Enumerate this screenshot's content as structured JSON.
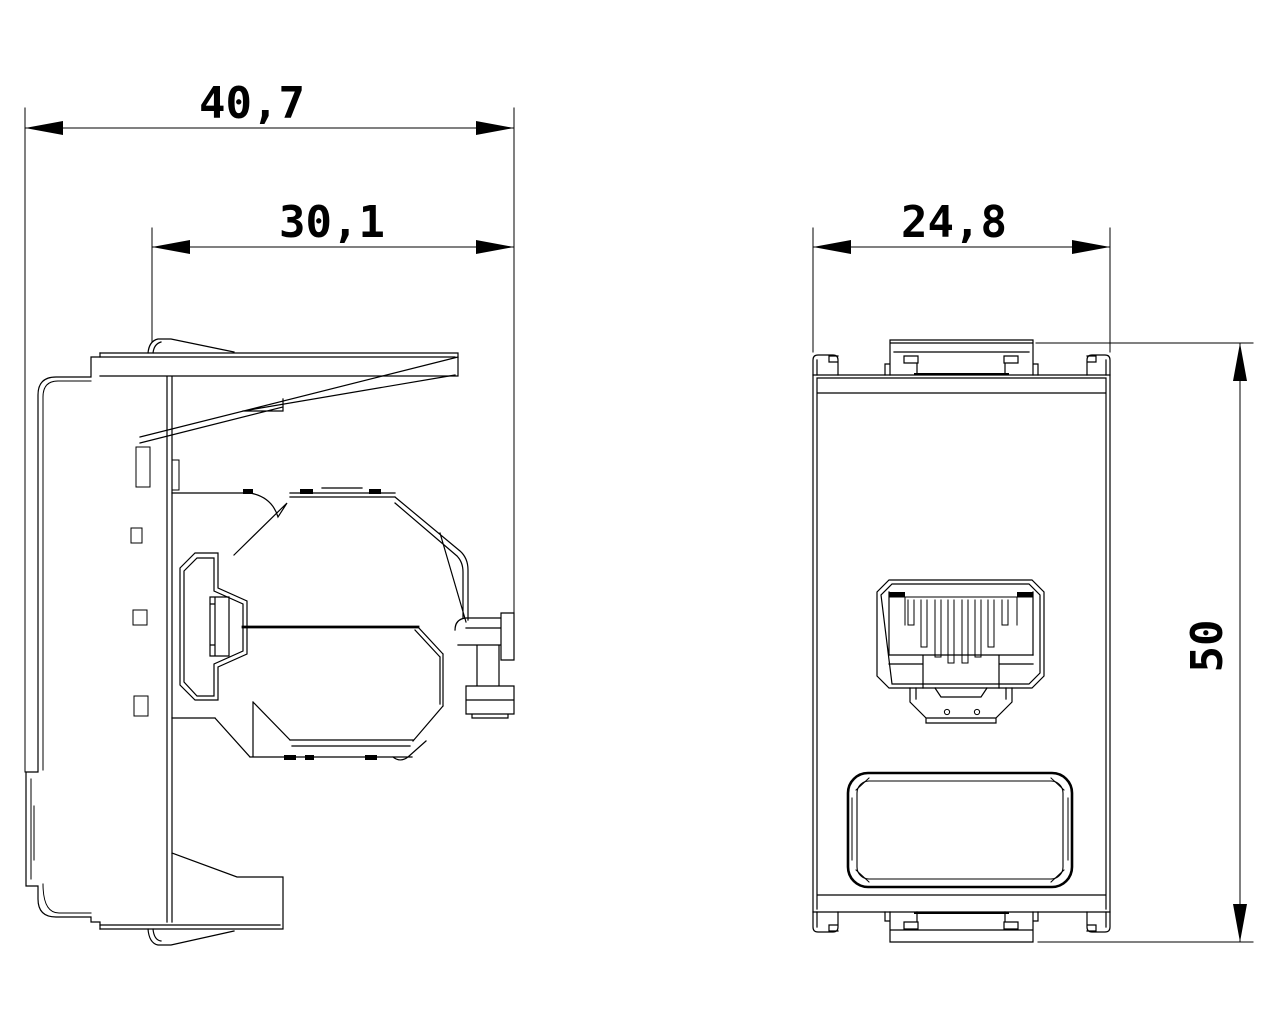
{
  "drawing": {
    "views": {
      "side_view": "side profile of flush-mount module with keystone jack",
      "front_view": "front face of module with RJ45 socket and label window"
    },
    "dimensions": {
      "side_overall_depth": {
        "label": "40,7"
      },
      "side_body_depth": {
        "label": "30,1"
      },
      "front_width": {
        "label": "24,8"
      },
      "front_height": {
        "label": "50"
      }
    },
    "line_color": "#000000",
    "background_color": "#ffffff"
  }
}
